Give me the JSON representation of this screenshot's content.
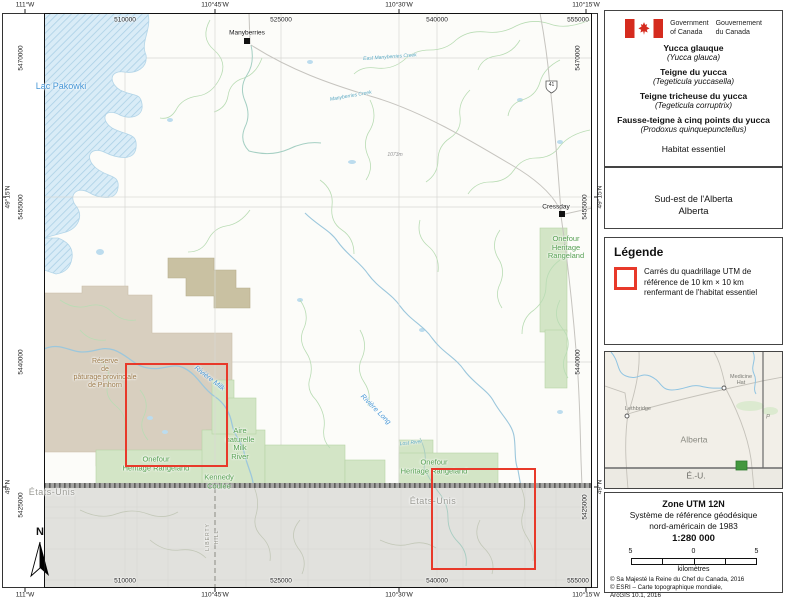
{
  "header": {
    "flag_icon": "canada-flag",
    "gov_en": "Government\nof Canada",
    "gov_fr": "Gouvernement\ndu Canada"
  },
  "title_block": {
    "species": [
      {
        "common": "Yucca glauque",
        "scientific": "(Yucca glauca)"
      },
      {
        "common": "Teigne du yucca",
        "scientific": "(Tegeticula yuccasella)"
      },
      {
        "common": "Teigne tricheuse du yucca",
        "scientific": "(Tegeticula corruptrix)"
      },
      {
        "common": "Fausse-teigne à cinq points du yucca",
        "scientific": "(Prodoxus quinquepunctellus)"
      }
    ],
    "subtitle": "Habitat essentiel"
  },
  "region_box": {
    "line1": "Sud-est de l'Alberta",
    "line2": "Alberta"
  },
  "legend": {
    "title": "Légende",
    "item_text": "Carrés du quadrillage UTM de\nréférence de 10 km × 10 km\nrenfermant de l'habitat essentiel",
    "symbol_color": "#e8392a"
  },
  "inset": {
    "medicine_hat": "Medicine\nHat",
    "lethbridge": "Lethbridge",
    "alberta": "Alberta",
    "etats_unis": "É.-U.",
    "p_label": "P"
  },
  "scale_panel": {
    "zone": "Zone UTM 12N",
    "datum": "Système de référence géodésique\nnord-américain de 1983",
    "scale": "1:280 000",
    "bar_left": "5",
    "bar_mid": "0",
    "bar_right": "5",
    "unit": "kilomètres",
    "credits": "© Sa Majesté la Reine du Chef du Canada, 2016\n© ESRI – Carte topographique mondiale,\nArcGIS 10.1, 2016"
  },
  "map": {
    "coords": {
      "top_deg": [
        "111°W",
        "110°45'W",
        "110°30'W",
        "110°15'W"
      ],
      "bottom_deg": [
        "111°W",
        "110°45'W",
        "110°30'W",
        "110°15'W"
      ],
      "top_utm": [
        "510000",
        "525000",
        "540000",
        "555000"
      ],
      "bottom_utm": [
        "510000",
        "525000",
        "540000",
        "555000"
      ],
      "left_deg": [
        "49°15'N",
        "49°N"
      ],
      "right_deg": [
        "49°15'N",
        "49°N"
      ],
      "left_utm": [
        "5470000",
        "5455000",
        "5440000",
        "5425000"
      ],
      "right_utm": [
        "5470000",
        "5455000",
        "5440000",
        "5425000"
      ]
    },
    "labels": {
      "lac_pakowki": "Lac Pakowki",
      "manyberries": "Manyberries",
      "cressday": "Cressday",
      "onefour_east": "Onefour\nHeritage\nRangeland",
      "onefour_west": "Onefour\nHeritage Rangeland",
      "onefour_center": "Onefour\nHeritage Rangeland",
      "reserve_pinhorn": "Réserve\nde\npâturage provinciale\nde Pinhorn",
      "aire_naturelle": "Aire\nnaturelle\nMilk\nRiver",
      "kennedy_coulee": "Kennedy\nCoulee",
      "etats_unis_west": "États-Unis",
      "etats_unis_east": "États-Unis",
      "riviere_milk": "Rivière Milk",
      "riviere_long": "Rivière Long",
      "manyberries_creek": "Manyberries Creek",
      "east_manyberries_creek": "East Manyberries Creek",
      "lost_river": "Lost River",
      "liberty_hill_line1": "LIBERTY",
      "liberty_hill_line2": "HILL",
      "elevation": "1073m",
      "highway_shield": "41",
      "north_arrow": "N"
    },
    "colors": {
      "habitat_square": "#e8392a",
      "protected_green": "#d3e5c6",
      "pinhorn_tan": "#d8cfbf",
      "lake_blue": "#cfe5f2",
      "us_gray": "#e1e1dd"
    }
  }
}
